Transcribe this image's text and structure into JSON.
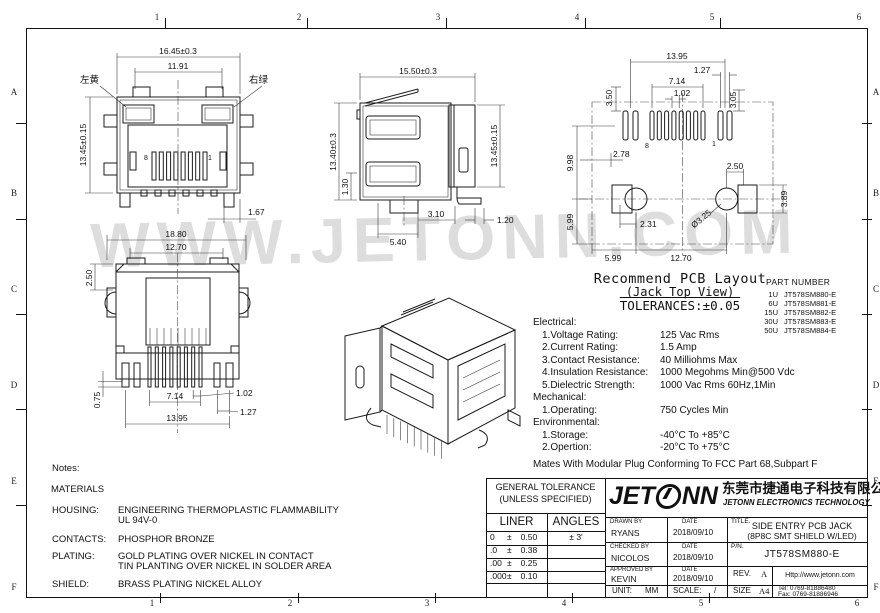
{
  "frame": {
    "cols": [
      "1",
      "2",
      "3",
      "4",
      "5",
      "6"
    ],
    "rows": [
      "A",
      "B",
      "C",
      "D",
      "E",
      "F"
    ]
  },
  "watermark": "WWW.JETONN.COM",
  "views": {
    "front": {
      "w": "16.45±0.3",
      "iw": "11.91",
      "h": "13.45±0.15",
      "p": "1.67",
      "led_left": "左黄",
      "led_right": "右绿",
      "pin8": "8",
      "pin1": "1"
    },
    "side": {
      "w": "15.50±0.3",
      "h": "13.40±0.3",
      "step": "1.30",
      "h2": "13.45±0.15",
      "a": "3.10",
      "b": "5.40",
      "c": "1.20"
    },
    "rear": {
      "w": "18.80",
      "iw": "12.70",
      "t": "2.50",
      "p1": "0.75",
      "p2": "7.14",
      "p3": "1.02",
      "p4": "1.27",
      "p5": "13.95"
    },
    "pcb": {
      "w": "13.95",
      "p1": "1.27",
      "p2": "7.14",
      "p3": "1.02",
      "v1": "3.50",
      "v2": "3.05",
      "v3": "9.98",
      "v4": "5.99",
      "h1": "2.78",
      "h2": "2.50",
      "v5": "3.89",
      "h3": "2.31",
      "dia": "Ø3.25",
      "b1": "5.99",
      "b2": "12.70",
      "pin8": "8",
      "pin1": "1"
    }
  },
  "pcb_note": {
    "l1": "Recommend PCB Layout",
    "l2": "(Jack Top View)",
    "l3": "TOLERANCES:±0.05"
  },
  "part_numbers": {
    "title": "PART NUMBER",
    "rows": [
      {
        "u": "1U",
        "pn": "JT578SM880-E"
      },
      {
        "u": "6U",
        "pn": "JT578SM881-E"
      },
      {
        "u": "15U",
        "pn": "JT578SM882-E"
      },
      {
        "u": "30U",
        "pn": "JT578SM883-E"
      },
      {
        "u": "50U",
        "pn": "JT578SM884-E"
      }
    ]
  },
  "specs": {
    "electrical_title": "Electrical:",
    "electrical": [
      {
        "k": "1.Voltage Rating:",
        "v": "125 Vac Rms"
      },
      {
        "k": "2.Current Rating:",
        "v": "1.5 Amp"
      },
      {
        "k": "3.Contact Resistance:",
        "v": "40 Milliohms Max"
      },
      {
        "k": "4.Insulation Resistance:",
        "v": "1000 Megohms Min@500 Vdc"
      },
      {
        "k": "5.Dielectric Strength:",
        "v": "1000 Vac Rms 60Hz,1Min"
      }
    ],
    "mechanical_title": "Mechanical:",
    "mechanical": [
      {
        "k": "1.Operating:",
        "v": "750 Cycles Min"
      }
    ],
    "environmental_title": "Environmental:",
    "environmental": [
      {
        "k": "1.Storage:",
        "v": "-40°C To +85°C"
      },
      {
        "k": "2.Opertion:",
        "v": "-20°C To +75°C"
      }
    ],
    "footnote": "Mates With Modular Plug Conforming To FCC Part 68,Subpart F"
  },
  "notes": {
    "title": "Notes:",
    "materials": "MATERIALS",
    "rows": [
      {
        "k": "HOUSING:",
        "l1": "ENGINEERING THERMOPLASTIC FLAMMABILITY",
        "l2": "UL 94V-0"
      },
      {
        "k": "CONTACTS:",
        "l1": "PHOSPHOR BRONZE",
        "l2": ""
      },
      {
        "k": "PLATING:",
        "l1": "GOLD PLATING OVER NICKEL IN CONTACT",
        "l2": "TIN PLANTING OVER NICKEL IN SOLDER AREA"
      },
      {
        "k": "SHIELD:",
        "l1": "BRASS PLATING NICKEL ALLOY",
        "l2": ""
      }
    ]
  },
  "titleblock": {
    "tolerance": {
      "h1": "GENERAL TOLERANCE",
      "h2": "(UNLESS SPECIFIED)",
      "c1": "LINER",
      "c2": "ANGLES",
      "pm": "±",
      "rows": [
        {
          "p": "0",
          "v": "0.50"
        },
        {
          "p": ".0",
          "v": "0.38"
        },
        {
          "p": ".00",
          "v": "0.25"
        },
        {
          "p": ".000",
          "v": "0.10"
        }
      ],
      "angle": "± 3'"
    },
    "logo": {
      "jet": "JET",
      "nn": "NN",
      "cn": "东莞市捷通电子科技有限公司",
      "en": "JETONN ELECTRONICS TECHNOLOGY"
    },
    "people": [
      {
        "role": "DRAWN BY",
        "name": "RYANS",
        "dl": "DATE",
        "date": "2018/09/10"
      },
      {
        "role": "CHECKED BY",
        "name": "NICOLOS",
        "dl": "DATE",
        "date": "2018/09/10"
      },
      {
        "role": "APPROVED BY",
        "name": "KEVIN",
        "dl": "DATE",
        "date": "2018/09/10"
      }
    ],
    "unit_label": "UNIT:",
    "unit": "MM",
    "scale_label": "SCALE:",
    "scale": "/",
    "title_label": "TITLE.",
    "title1": "SIDE ENTRY PCB JACK",
    "title2": "(8P8C SMT SHIELD W/LED)",
    "pn_label": "P/N.",
    "pn": "JT578SM880-E",
    "rev_label": "REV.",
    "rev": "A",
    "size_label": "SIZE",
    "size": "A4",
    "web": "Http://www.jetonn.com",
    "tel": "Tel: 0769-81886480",
    "fax": "Fax: 0769-81886946"
  }
}
